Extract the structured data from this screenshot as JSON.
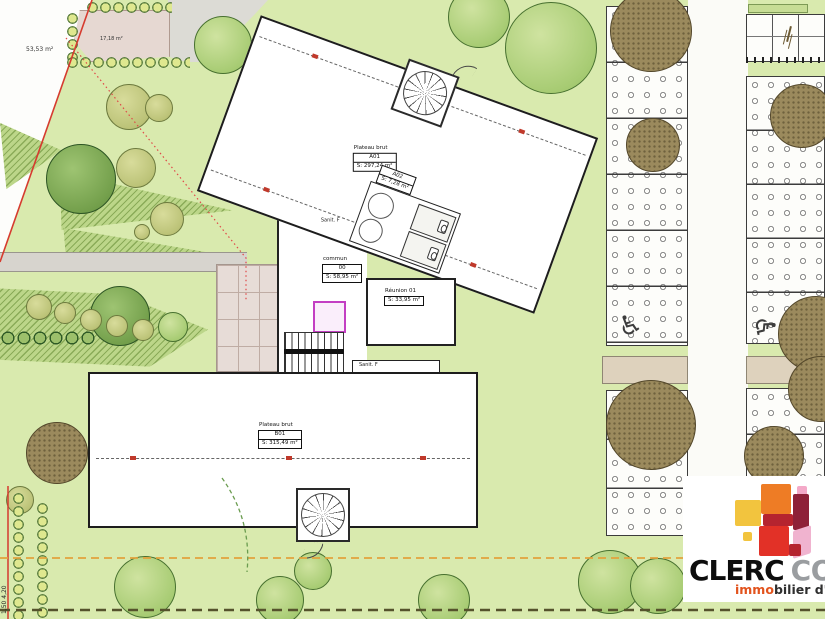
{
  "site": {
    "areas": {
      "parcel_left": "53,53 m²",
      "garden_patio": "17,18 m²"
    },
    "buildings": {
      "upper": {
        "title": "Plateau brut",
        "code": "A01",
        "area": "S: 297,24 m²"
      },
      "lower": {
        "title": "Plateau brut",
        "code": "B01",
        "area": "S: 315,49 m²"
      }
    },
    "rooms": {
      "sanit_upper": {
        "name": "Sanit. F",
        "code": "A02",
        "area": "S: 7,28 m²"
      },
      "commun": {
        "name": "commun",
        "code": "00",
        "area": "S: 58,95 m²"
      },
      "reunion": {
        "name": "Réunion 01",
        "area": "S: 33,95 m²"
      },
      "sanit_lower": {
        "name": "Sanit. F",
        "code": "B02",
        "area": "S: 7,28 m²"
      }
    },
    "dimensions": {
      "left_edge": "1,50   4,20"
    },
    "icons": {
      "accessible_parking": "♿"
    }
  },
  "logo": {
    "brand": "CLERC",
    "brand2": "CONSEIL",
    "tagline_accent": "immo",
    "tagline_rest": "bilier d'entreprise",
    "colors": {
      "yellow": "#f2c43e",
      "orange": "#ee7c25",
      "red": "#e23127",
      "dark_red": "#8e2138",
      "crimson": "#b5242f",
      "pink": "#f0b3cf",
      "magenta": "#e2449a"
    }
  },
  "palette": {
    "site_green": "#d9eaae",
    "boundary_red": "#d63b2f",
    "boundary_orange": "#e2a23c",
    "boundary_olive": "#55522c",
    "elevator_magenta": "#c33fc3"
  }
}
